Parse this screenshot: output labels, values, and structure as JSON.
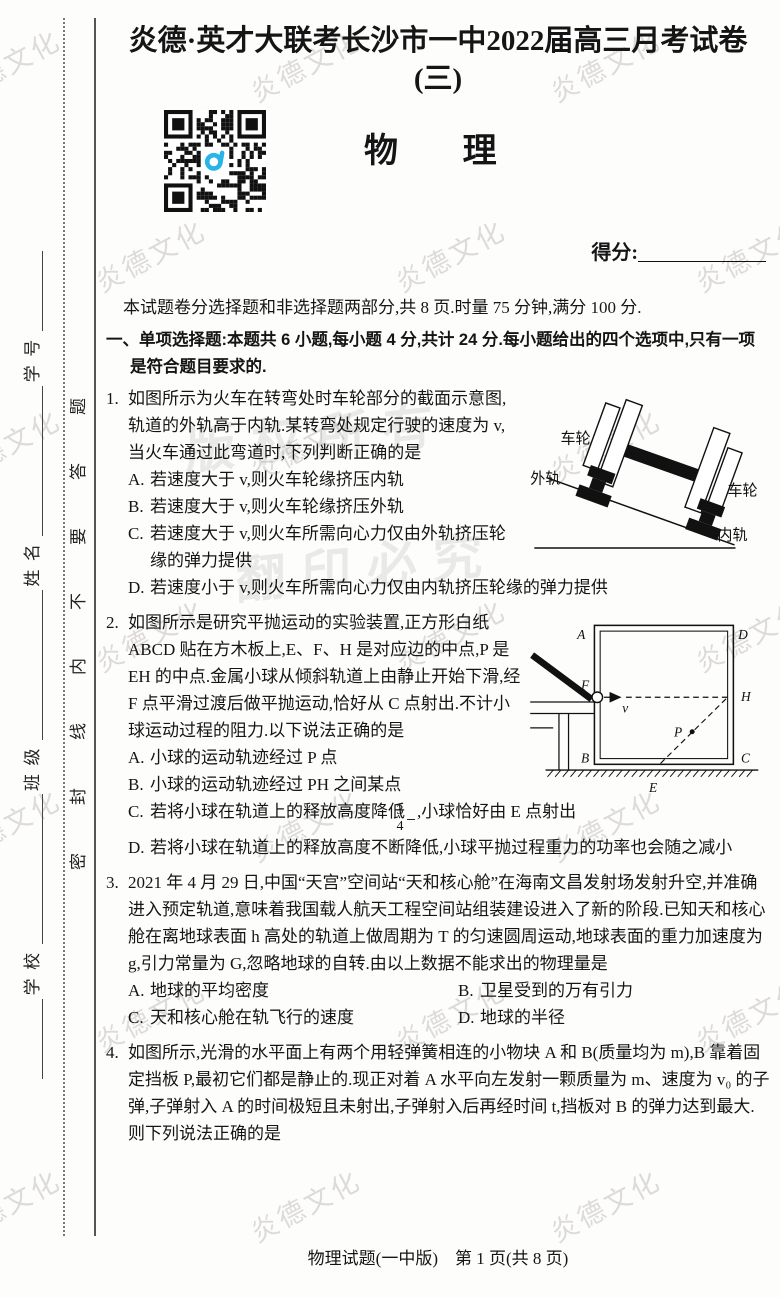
{
  "header": {
    "title": "炎德·英才大联考长沙市一中2022届高三月考试卷(三)",
    "subject": "物　理",
    "score_label": "得分:",
    "intro": "本试题卷分选择题和非选择题两部分,共 8 页.时量 75 分钟,满分 100 分."
  },
  "section": {
    "heading": "一、单项选择题:本题共 6 小题,每小题 4 分,共计 24 分.每小题给出的四个选项中,只有一项是符合题目要求的."
  },
  "sidebar": {
    "seal_text": "密封线内不要答题",
    "fields": [
      "学号",
      "姓名",
      "班级",
      "学校"
    ]
  },
  "watermark": {
    "tile_text": "炎德文化",
    "big_text_1": "版权所有",
    "big_text_2": "翻印必究"
  },
  "questions": [
    {
      "number": "1.",
      "stem": "如图所示为火车在转弯处时车轮部分的截面示意图,轨道的外轨高于内轨.某转弯处规定行驶的速度为 v,当火车通过此弯道时,下列判断正确的是",
      "options": [
        {
          "label": "A.",
          "text": "若速度大于 v,则火车轮缘挤压内轨"
        },
        {
          "label": "B.",
          "text": "若速度大于 v,则火车轮缘挤压外轨"
        },
        {
          "label": "C.",
          "text": "若速度大于 v,则火车所需向心力仅由外轨挤压轮缘的弹力提供"
        },
        {
          "label": "D.",
          "text": "若速度小于 v,则火车所需向心力仅由内轨挤压轮缘的弹力提供"
        }
      ],
      "fig": {
        "wheel_left": "车轮",
        "outer_rail": "外轨",
        "wheel_right": "车轮",
        "inner_rail": "内轨"
      }
    },
    {
      "number": "2.",
      "stem": "如图所示是研究平抛运动的实验装置,正方形白纸 ABCD 贴在方木板上,E、F、H 是对应边的中点,P 是 EH 的中点.金属小球从倾斜轨道上由静止开始下滑,经 F 点平滑过渡后做平抛运动,恰好从 C 点射出.不计小球运动过程的阻力.以下说法正确的是",
      "options": [
        {
          "label": "A.",
          "text": "小球的运动轨迹经过 P 点"
        },
        {
          "label": "B.",
          "text": "小球的运动轨迹经过 PH 之间某点"
        },
        {
          "label": "C.",
          "text_before": "若将小球在轨道上的释放高度降低",
          "frac_num": "3",
          "frac_den": "4",
          "text_after": ",小球恰好由 E 点射出"
        },
        {
          "label": "D.",
          "text": "若将小球在轨道上的释放高度不断降低,小球平抛过程重力的功率也会随之减小"
        }
      ],
      "fig": {
        "A": "A",
        "B": "B",
        "C": "C",
        "D": "D",
        "E": "E",
        "F": "F",
        "H": "H",
        "P": "P",
        "v": "v"
      }
    },
    {
      "number": "3.",
      "stem": "2021 年 4 月 29 日,中国“天宫”空间站“天和核心舱”在海南文昌发射场发射升空,并准确进入预定轨道,意味着我国载人航天工程空间站组装建设进入了新的阶段.已知天和核心舱在离地球表面 h 高处的轨道上做周期为 T 的匀速圆周运动,地球表面的重力加速度为 g,引力常量为 G,忽略地球的自转.由以上数据不能求出的物理量是",
      "options": [
        {
          "label": "A.",
          "text": "地球的平均密度"
        },
        {
          "label": "B.",
          "text": "卫星受到的万有引力"
        },
        {
          "label": "C.",
          "text": "天和核心舱在轨飞行的速度"
        },
        {
          "label": "D.",
          "text": "地球的半径"
        }
      ]
    },
    {
      "number": "4.",
      "stem": "如图所示,光滑的水平面上有两个用轻弹簧相连的小物块 A 和 B(质量均为 m),B 靠着固定挡板 P,最初它们都是静止的.现正对着 A 水平向左发射一颗质量为 m、速度为 v₀ 的子弹,子弹射入 A 的时间极短且未射出,子弹射入后再经时间 t,挡板对 B 的弹力达到最大.则下列说法正确的是",
      "options": []
    }
  ],
  "footer": {
    "text": "物理试题(一中版)　第 1 页(共 8 页)"
  }
}
